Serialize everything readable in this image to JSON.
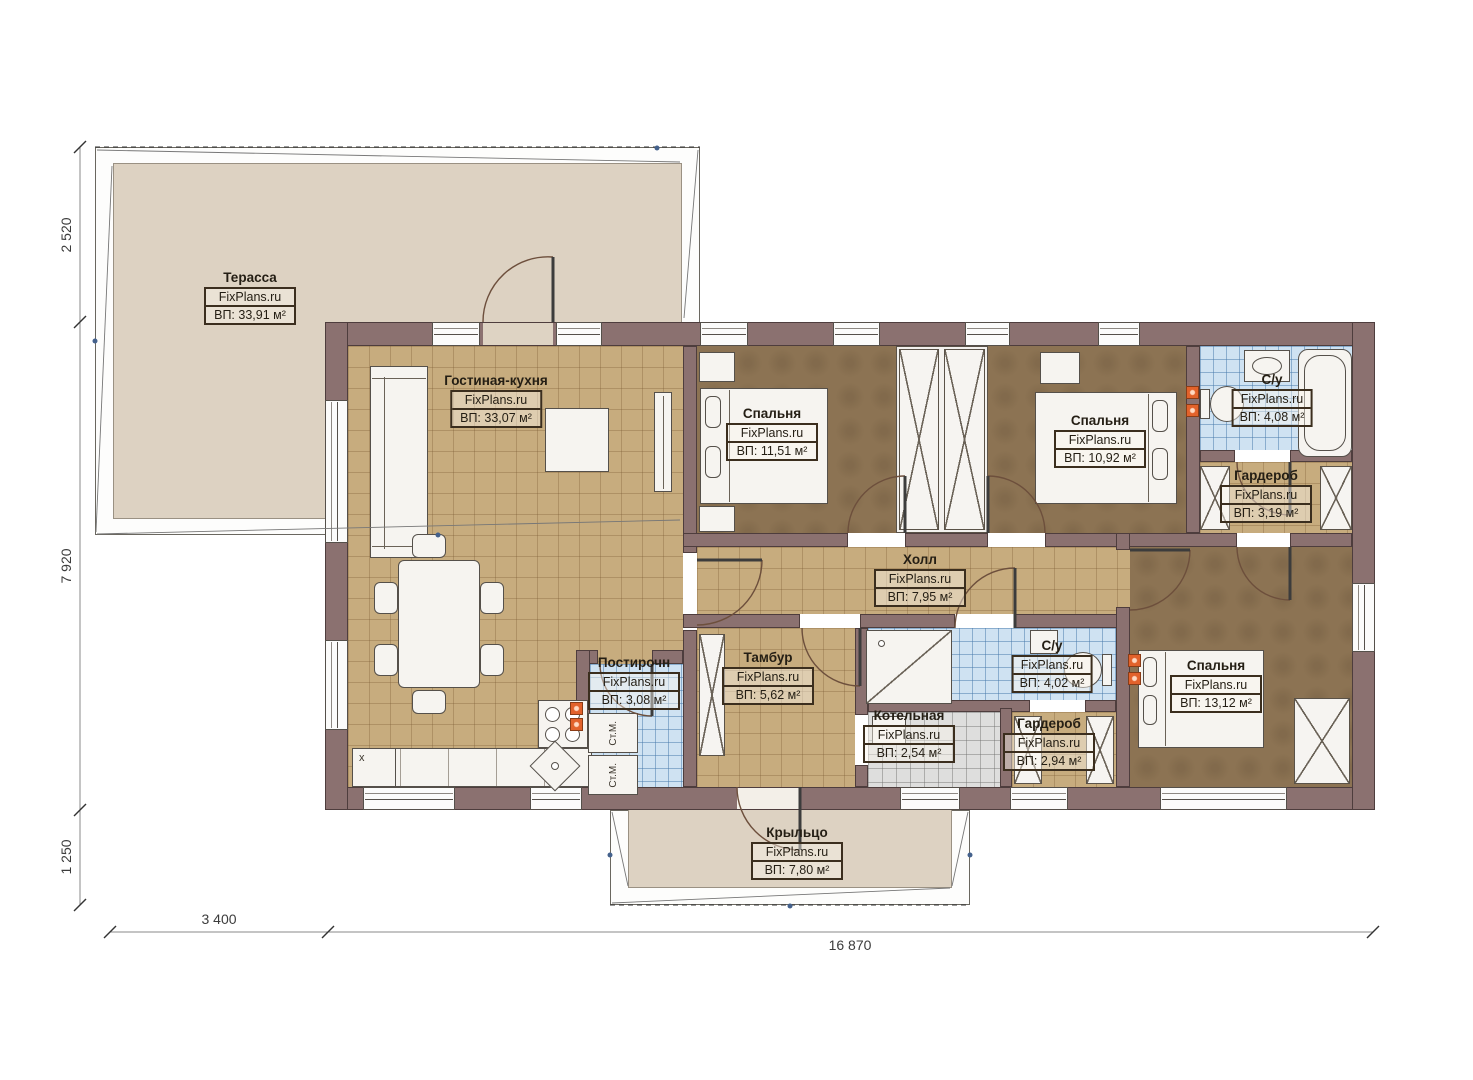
{
  "plan": {
    "brand": "FixPlans.ru",
    "rooms": {
      "terrace": {
        "name": "Терасса",
        "area": "ВП: 33,91 м²"
      },
      "living": {
        "name": "Гостиная-кухня",
        "area": "ВП: 33,07 м²"
      },
      "bedroom1": {
        "name": "Спальня",
        "area": "ВП: 11,51 м²"
      },
      "bedroom2": {
        "name": "Спальня",
        "area": "ВП: 10,92 м²"
      },
      "bathroom1": {
        "name": "С/у",
        "area": "ВП: 4,08 м²"
      },
      "wardrobe1": {
        "name": "Гардероб",
        "area": "ВП: 3,19 м²"
      },
      "hall": {
        "name": "Холл",
        "area": "ВП: 7,95 м²"
      },
      "tambour": {
        "name": "Тамбур",
        "area": "ВП: 5,62 м²"
      },
      "laundry": {
        "name": "Постирочн",
        "area": "ВП: 3,08 м²"
      },
      "bathroom2": {
        "name": "С/у",
        "area": "ВП: 4,02 м²"
      },
      "boiler": {
        "name": "Котельная",
        "area": "ВП: 2,54 м²"
      },
      "wardrobe2": {
        "name": "Гардероб",
        "area": "ВП: 2,94 м²"
      },
      "bedroom3": {
        "name": "Спальня",
        "area": "ВП: 13,12 м²"
      },
      "porch": {
        "name": "Крыльцо",
        "area": "ВП: 7,80 м²"
      }
    },
    "appliances": {
      "washer": "Ст.М.",
      "corner_mark": "x"
    },
    "dimensions": {
      "left": [
        "2 520",
        "7 920",
        "1 250"
      ],
      "bottom": [
        "3 400",
        "16 870"
      ]
    },
    "colors": {
      "wall": "#8b7170",
      "floor_wood": "#c7ac7e",
      "floor_bedroom": "#8c7353",
      "floor_tile_blue": "#cfe2f2",
      "floor_terrace": "#ddd2c2",
      "marker_orange": "#e2622b"
    }
  }
}
